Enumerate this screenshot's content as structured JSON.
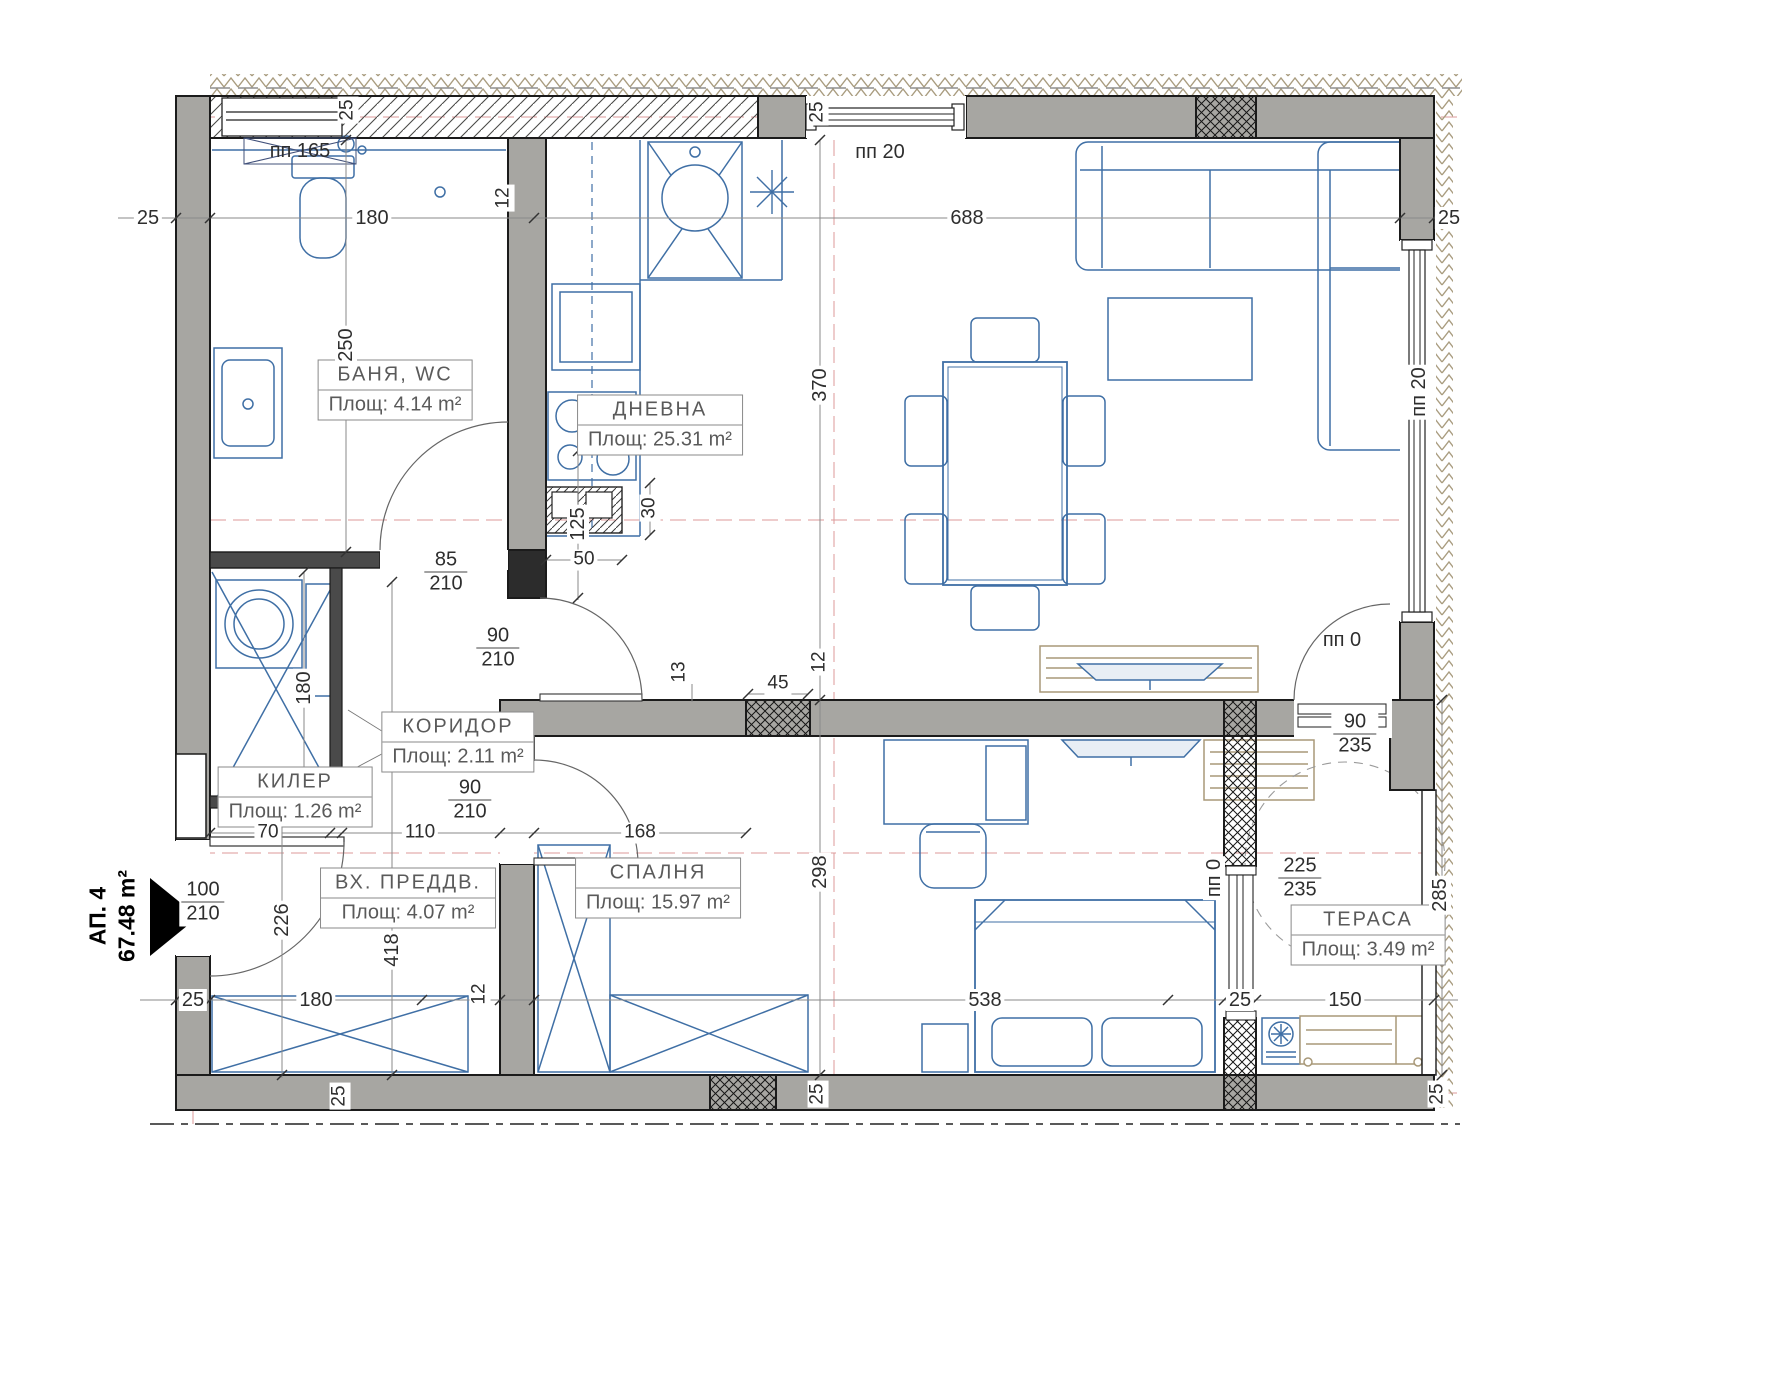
{
  "apartment": {
    "name": "АП. 4",
    "area": "67.48 m²"
  },
  "rooms": {
    "bath": {
      "name": "БАНЯ, WC",
      "area": "Площ: 4.14 m²"
    },
    "living": {
      "name": "ДНЕВНА",
      "area": "Площ: 25.31 m²"
    },
    "corridor": {
      "name": "КОРИДОР",
      "area": "Площ: 2.11 m²"
    },
    "closet": {
      "name": "КИЛЕР",
      "area": "Площ: 1.26 m²"
    },
    "entry": {
      "name": "ВХ. ПРЕДДВ.",
      "area": "Площ: 4.07 m²"
    },
    "bedroom": {
      "name": "СПАЛНЯ",
      "area": "Площ: 15.97 m²"
    },
    "terrace": {
      "name": "ТЕРАСА",
      "area": "Площ: 3.49 m²"
    }
  },
  "openings": {
    "w165": "пп 165",
    "w20_top": "пп 20",
    "w20_right": "пп 20",
    "d0_living": "пп 0",
    "d0_terrace": "пп 0"
  },
  "door_sizes": {
    "bath": {
      "w": "85",
      "h": "210"
    },
    "living": {
      "w": "90",
      "h": "210"
    },
    "bedroom": {
      "w": "90",
      "h": "210"
    },
    "entrance": {
      "w": "100",
      "h": "210"
    },
    "terrace_door": {
      "w": "90",
      "h": "235"
    },
    "terrace_window": {
      "w": "225",
      "h": "235"
    }
  },
  "dims": {
    "wall_left": "25",
    "bath_width": "180",
    "living_width": "688",
    "wall_right": "25",
    "off_w165": "25",
    "off_w20": "25",
    "bath_wall": "12",
    "bath_depth": "250",
    "living_height": "370",
    "shaft_h": "30",
    "shaft_w": "50",
    "door_off": "125",
    "closet_w": "70",
    "corridor_w": "110",
    "corridor_len": "168",
    "wall_off": "13",
    "pier": "45",
    "wall12": "12",
    "closet_h": "180",
    "hall_len": "418",
    "entry_len": "226",
    "bedroom_h": "298",
    "bedroom_w": "538",
    "terrace_h": "285",
    "terrace_w": "150",
    "bot_wall_a": "25",
    "wardrobe_w": "180",
    "wall12b": "12",
    "bot_pier": "25",
    "bot_t1": "25",
    "bot_t2": "25",
    "bot_t3": "25"
  }
}
